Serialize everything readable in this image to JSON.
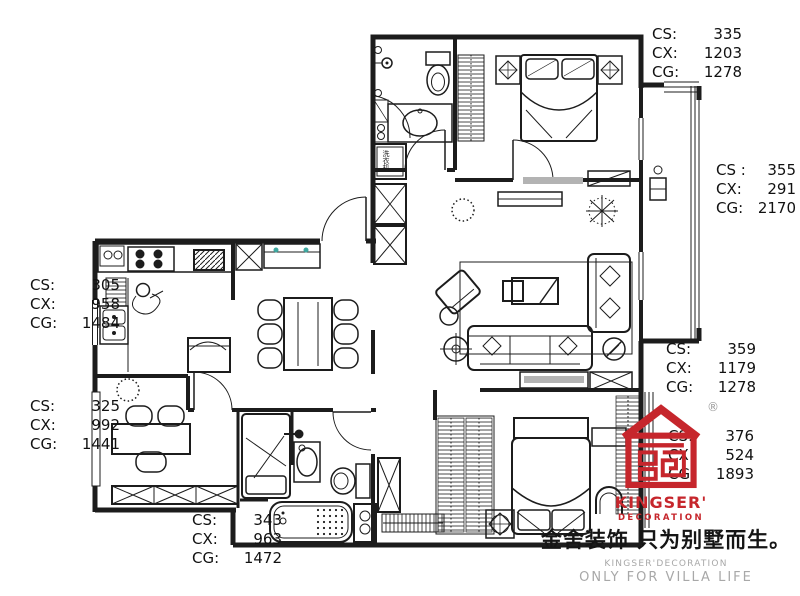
{
  "floor_plan": {
    "washing_machine_label": "洗衣机",
    "line_color": "#1c1c1c",
    "accent_teal": "#3fa8a0",
    "shelf_gray": "#b3b3b3"
  },
  "dimensions": {
    "top_right": {
      "rows": [
        {
          "label": "CS:",
          "value": "335"
        },
        {
          "label": "CX:",
          "value": "1203"
        },
        {
          "label": "CG:",
          "value": "1278"
        }
      ]
    },
    "right_middle": {
      "rows": [
        {
          "label": "CS :",
          "value": "355"
        },
        {
          "label": "CX:",
          "value": "291"
        },
        {
          "label": "CG:",
          "value": "2170"
        }
      ]
    },
    "right_lower": {
      "rows": [
        {
          "label": "CS:",
          "value": "359"
        },
        {
          "label": "CX:",
          "value": "1179"
        },
        {
          "label": "CG:",
          "value": "1278"
        }
      ]
    },
    "right_bottom": {
      "rows": [
        {
          "label": "CS:",
          "value": "376"
        },
        {
          "label": "CX:",
          "value": "524"
        },
        {
          "label": "CG:",
          "value": "1893"
        }
      ]
    },
    "left_upper": {
      "rows": [
        {
          "label": "CS:",
          "value": "305"
        },
        {
          "label": "CX:",
          "value": "958"
        },
        {
          "label": "CG:",
          "value": "1484"
        }
      ]
    },
    "left_lower": {
      "rows": [
        {
          "label": "CS:",
          "value": "325"
        },
        {
          "label": "CX:",
          "value": "992"
        },
        {
          "label": "CG:",
          "value": "1441"
        }
      ]
    },
    "bottom": {
      "rows": [
        {
          "label": "CS:",
          "value": "343"
        },
        {
          "label": "CX:",
          "value": "963"
        },
        {
          "label": "CG:",
          "value": "1472"
        }
      ]
    }
  },
  "branding": {
    "brand_red": "#c6262c",
    "registered_mark": "®",
    "logo_line1": "KINGSER'",
    "logo_line2": "DECORATION",
    "slogan_cn": "金舍装饰 只为别墅而生。",
    "slogan_en_small": "KINGSER'DECORATION",
    "slogan_en_large": "ONLY FOR VILLA LIFE"
  }
}
